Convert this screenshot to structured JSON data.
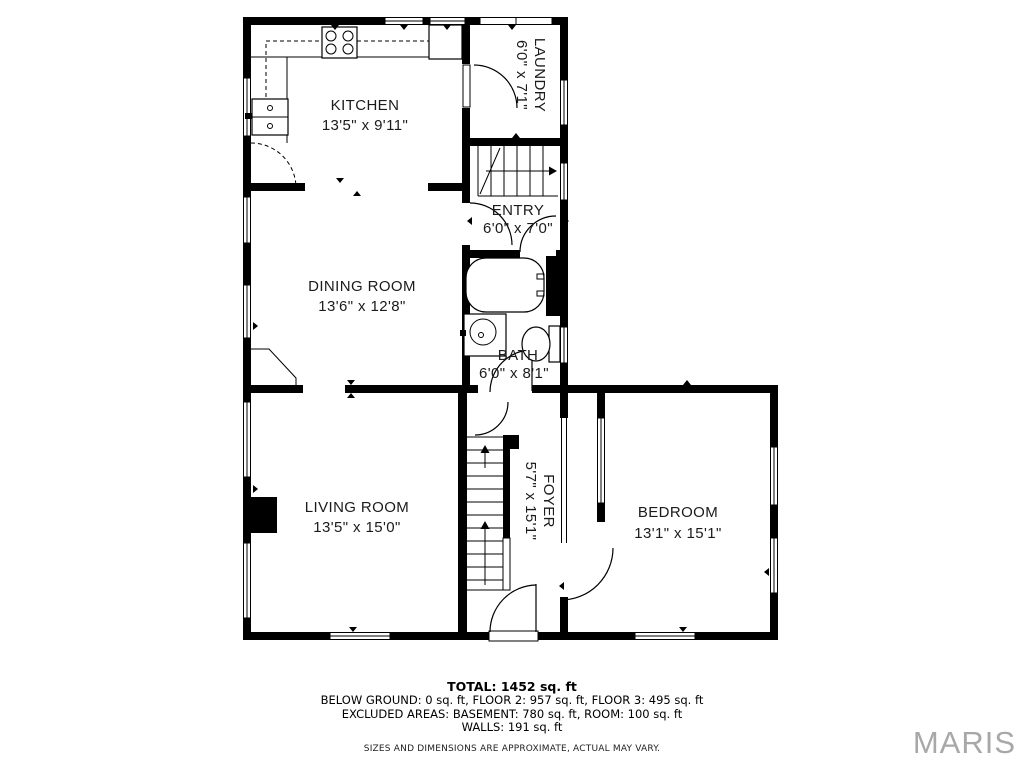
{
  "rooms": {
    "kitchen": {
      "name": "KITCHEN",
      "dims": "13'5\" x 9'11\""
    },
    "laundry": {
      "name": "LAUNDRY",
      "dims": "6'0\" x 7'1\""
    },
    "entry": {
      "name": "ENTRY",
      "dims": "6'0\" x 7'0\""
    },
    "dining": {
      "name": "DINING ROOM",
      "dims": "13'6\" x 12'8\""
    },
    "bath": {
      "name": "BATH",
      "dims": "6'0\" x 8'1\""
    },
    "living": {
      "name": "LIVING ROOM",
      "dims": "13'5\" x 15'0\""
    },
    "foyer": {
      "name": "FOYER",
      "dims": "5'7\" x 15'1\""
    },
    "bedroom": {
      "name": "BEDROOM",
      "dims": "13'1\" x 15'1\""
    }
  },
  "summary": {
    "total": "TOTAL: 1452 sq. ft",
    "line1": "BELOW GROUND: 0 sq. ft, FLOOR 2: 957 sq. ft, FLOOR 3: 495 sq. ft",
    "line2": "EXCLUDED AREAS: BASEMENT: 780 sq. ft, ROOM: 100 sq. ft",
    "line3": "WALLS: 191 sq. ft",
    "disclaimer": "SIZES AND DIMENSIONS ARE APPROXIMATE, ACTUAL MAY VARY."
  },
  "watermark": "MARIS",
  "colors": {
    "wall": "#000000",
    "background": "#ffffff",
    "label": "#1b1b1b",
    "watermark": "#a8a8a8"
  }
}
